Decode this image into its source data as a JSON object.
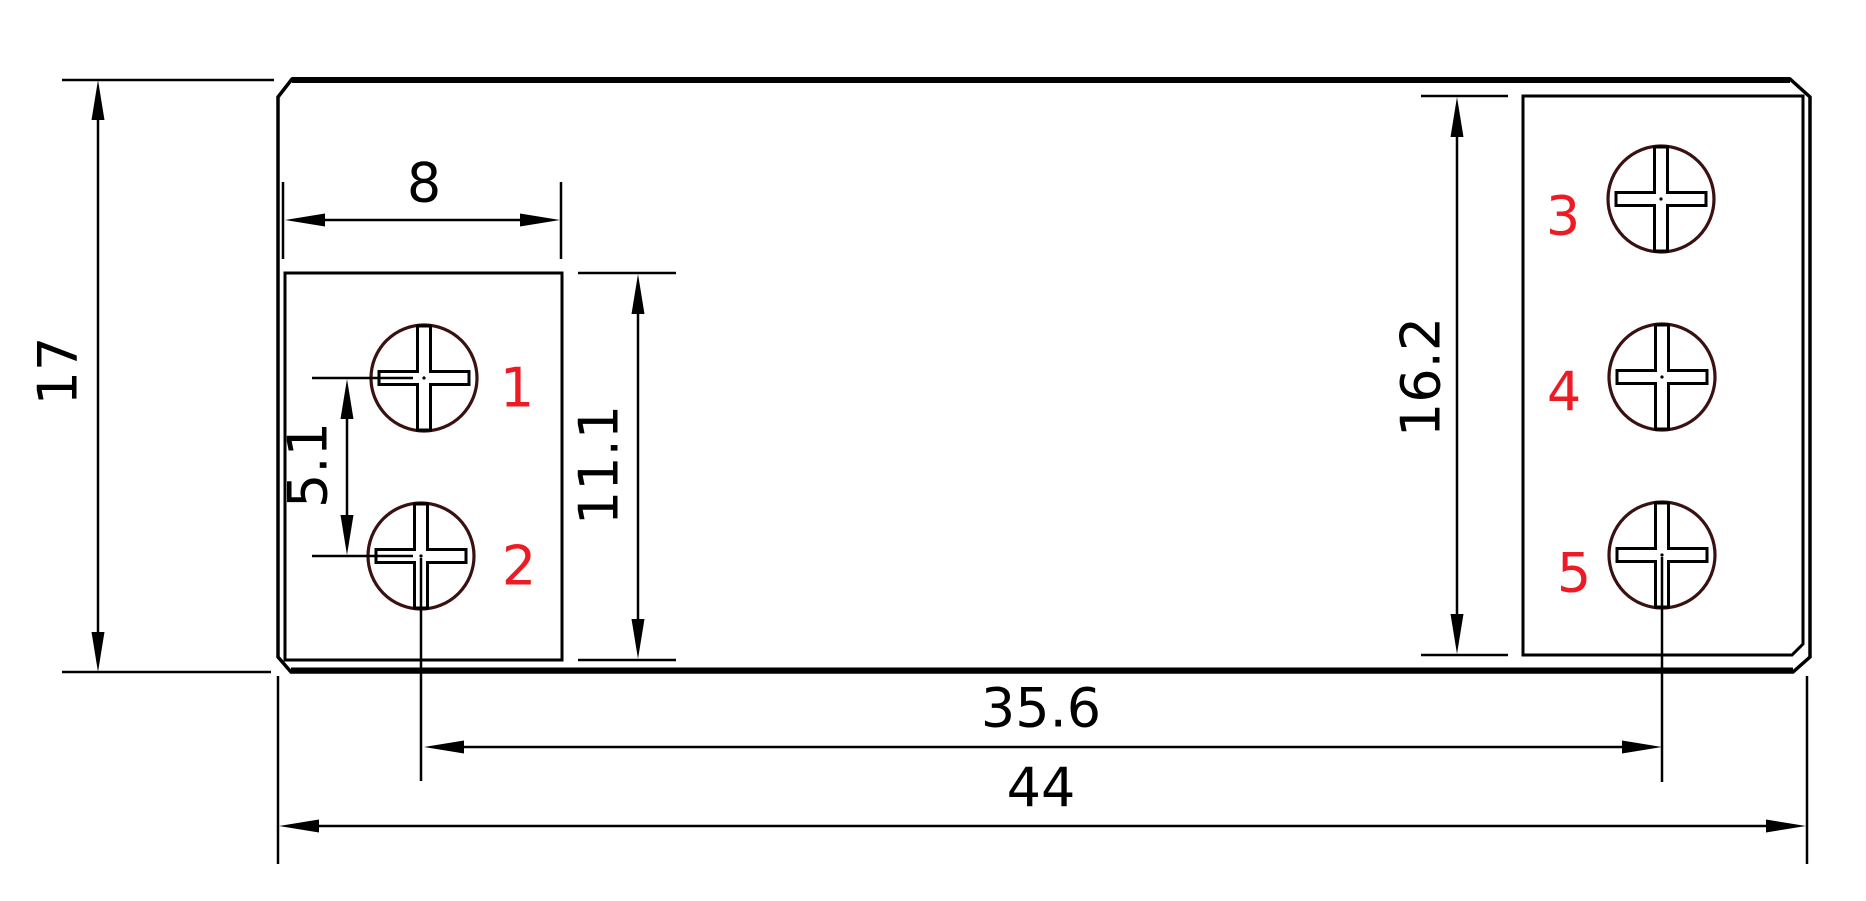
{
  "drawing": {
    "kind": "technical-dimension-drawing",
    "dims": {
      "overall_height": "17",
      "overall_width": "44",
      "left_block_width": "8",
      "screw_pitch": "5.1",
      "left_block_height": "11.1",
      "right_block_height": "16.2",
      "screw_span": "35.6"
    },
    "screw_labels": {
      "s1": "1",
      "s2": "2",
      "s3": "3",
      "s4": "4",
      "s5": "5"
    },
    "colors": {
      "line": "#000000",
      "screw_outline": "#3a1111",
      "label": "#ed1c24",
      "background": "#ffffff"
    }
  }
}
